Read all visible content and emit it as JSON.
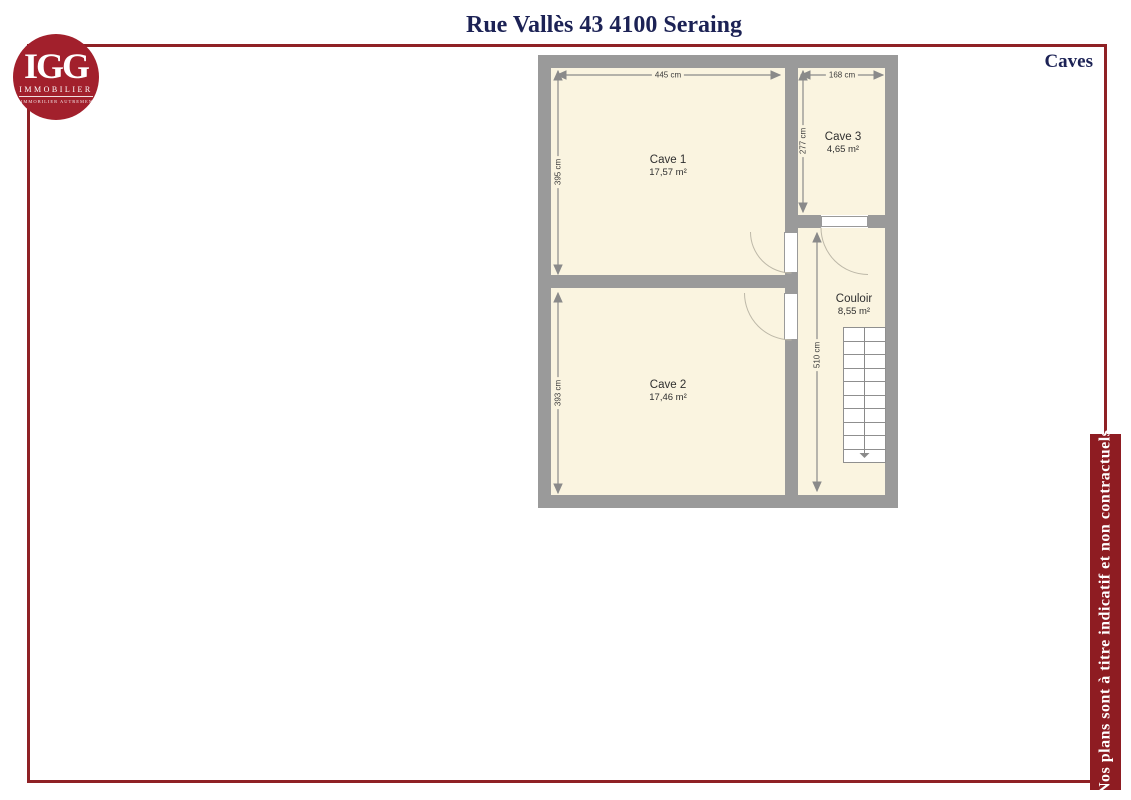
{
  "header": {
    "title": "Rue Vallès 43 4100 Seraing",
    "plan_label": "Caves"
  },
  "logo": {
    "brand": "IGG",
    "subtitle": "IMMOBILIER",
    "tagline": "L'IMMOBILIER AUTREMENT"
  },
  "footer": {
    "disclaimer": "Nos plans sont à titre indicatif et non contractuels"
  },
  "plan": {
    "rooms": [
      {
        "name": "Cave 1",
        "area": "17,57 m²"
      },
      {
        "name": "Cave 2",
        "area": "17,46 m²"
      },
      {
        "name": "Cave 3",
        "area": "4,65 m²"
      },
      {
        "name": "Couloir",
        "area": "8,55 m²"
      }
    ],
    "dimensions": {
      "cave1_width": "445 cm",
      "cave1_height": "395 cm",
      "cave2_height": "393 cm",
      "cave3_width": "168 cm",
      "cave3_height": "277 cm",
      "couloir_height": "510 cm"
    },
    "stairs": {
      "steps": 10
    }
  },
  "colors": {
    "brand_red": "#a2202c",
    "frame_red": "#8f2125",
    "banner_red": "#8e1c22",
    "navy": "#1c2255",
    "wall_gray": "#9a9a9a",
    "room_cream": "#faf4e0"
  }
}
